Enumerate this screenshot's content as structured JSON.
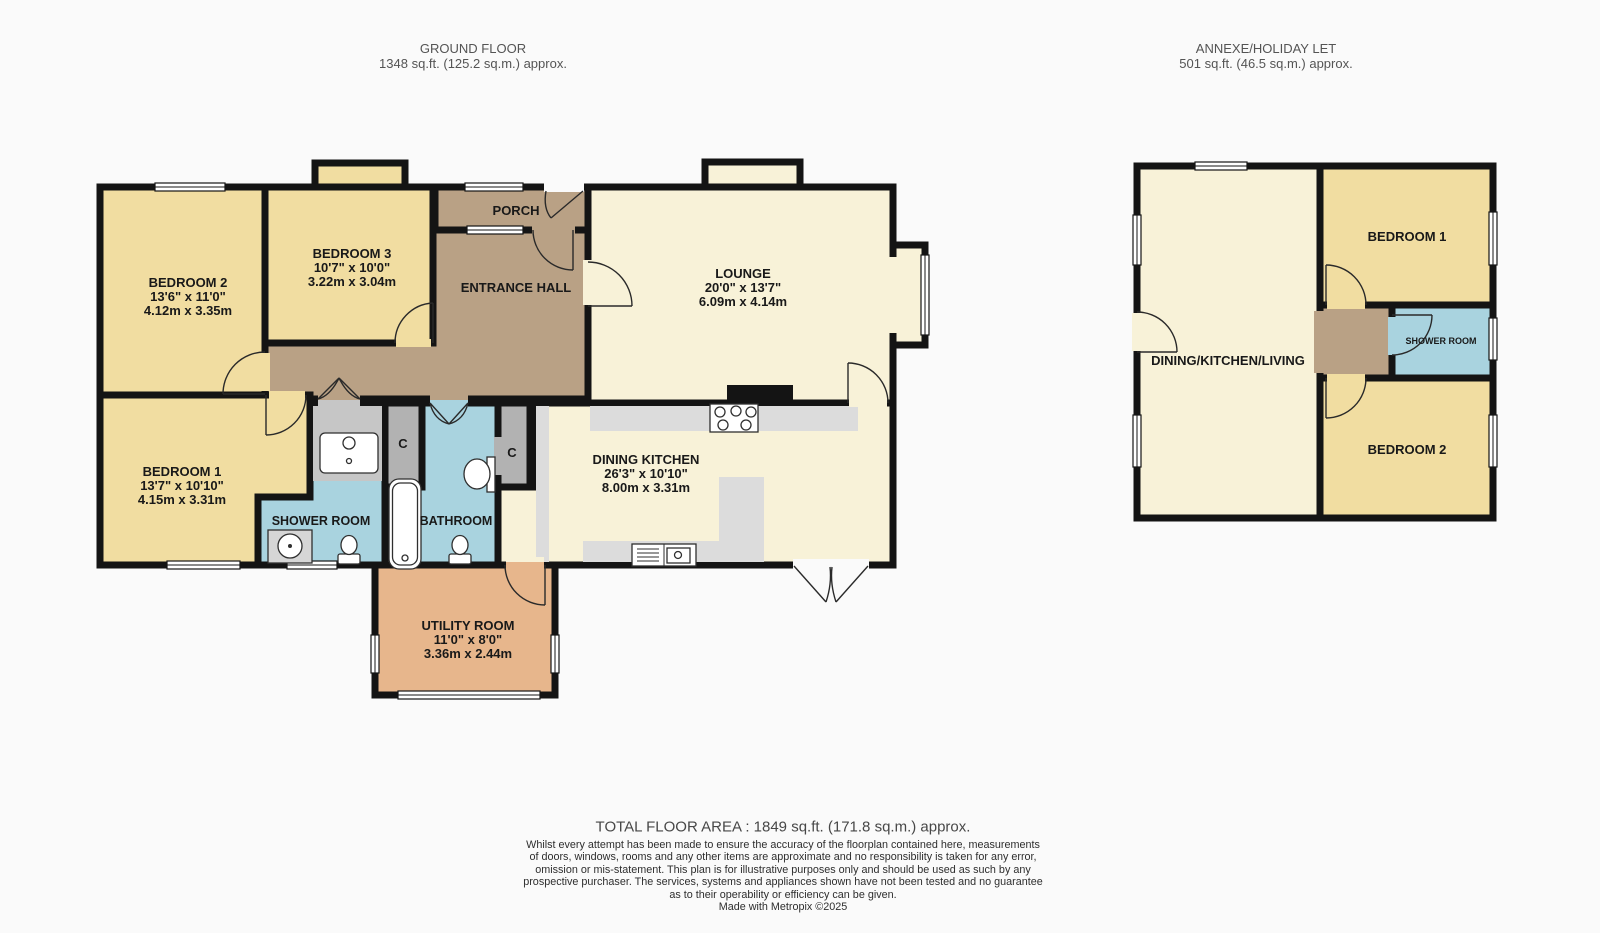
{
  "ground_floor": {
    "title": "GROUND FLOOR",
    "area": "1348 sq.ft. (125.2 sq.m.) approx.",
    "rooms": {
      "bedroom2": {
        "name": "BEDROOM 2",
        "imperial": "13'6\" x 11'0\"",
        "metric": "4.12m x 3.35m"
      },
      "bedroom3": {
        "name": "BEDROOM 3",
        "imperial": "10'7\" x 10'0\"",
        "metric": "3.22m x 3.04m"
      },
      "porch": {
        "name": "PORCH"
      },
      "entrance_hall": {
        "name": "ENTRANCE HALL"
      },
      "lounge": {
        "name": "LOUNGE",
        "imperial": "20'0\" x 13'7\"",
        "metric": "6.09m x 4.14m"
      },
      "bedroom1": {
        "name": "BEDROOM 1",
        "imperial": "13'7\" x 10'10\"",
        "metric": "4.15m x 3.31m"
      },
      "shower_room": {
        "name": "SHOWER ROOM"
      },
      "bathroom": {
        "name": "BATHROOM"
      },
      "closet1": {
        "name": "C"
      },
      "closet2": {
        "name": "C"
      },
      "dining_kitchen": {
        "name": "DINING KITCHEN",
        "imperial": "26'3\" x 10'10\"",
        "metric": "8.00m x 3.31m"
      },
      "utility": {
        "name": "UTILITY ROOM",
        "imperial": "11'0\" x 8'0\"",
        "metric": "3.36m x 2.44m"
      }
    }
  },
  "annexe": {
    "title": "ANNEXE/HOLIDAY LET",
    "area": "501 sq.ft. (46.5 sq.m.) approx.",
    "rooms": {
      "dkl": {
        "name": "DINING/KITCHEN/LIVING"
      },
      "bedroom1": {
        "name": "BEDROOM 1"
      },
      "shower_room": {
        "name": "SHOWER ROOM"
      },
      "bedroom2": {
        "name": "BEDROOM 2"
      }
    }
  },
  "footer": {
    "total": "TOTAL FLOOR AREA : 1849 sq.ft. (171.8 sq.m.) approx.",
    "disclaimer_lines": [
      "Whilst every attempt has been made to ensure the accuracy of the floorplan contained here, measurements",
      "of doors, windows, rooms and any other items are approximate and no responsibility is taken for any error,",
      "omission or mis-statement. This plan is for illustrative purposes only and should be used as such by any",
      "prospective purchaser. The services, systems and appliances shown have not been tested and no guarantee",
      "as to their operability or efficiency can be given.",
      "Made with Metropix ©2025"
    ]
  },
  "colors": {
    "room_yellow": "#f1dda1",
    "room_cream": "#f8f2d8",
    "hall_brown": "#b9a185",
    "utility_salmon": "#e7b68c",
    "wet_room_blue": "#a9d3df",
    "closet_gray": "#b2b2b2",
    "counter_gray": "#dcdcdc",
    "wall_black": "#141414"
  }
}
